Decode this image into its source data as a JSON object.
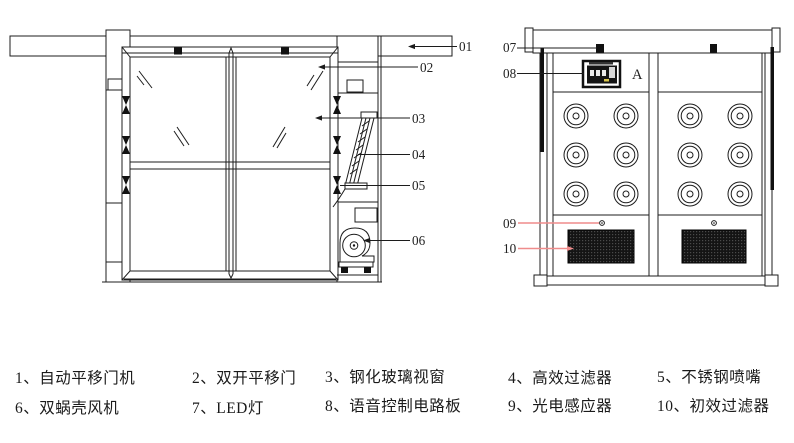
{
  "left_view": {
    "callouts": [
      {
        "label": "01"
      },
      {
        "label": "02"
      },
      {
        "label": "03"
      },
      {
        "label": "04"
      },
      {
        "label": "05"
      },
      {
        "label": "06"
      }
    ]
  },
  "right_view": {
    "callouts": [
      {
        "label": "07"
      },
      {
        "label": "08"
      },
      {
        "label": "09"
      },
      {
        "label": "10"
      }
    ],
    "detail_marker": "A"
  },
  "legend": {
    "items": [
      {
        "label": "1、自动平移门机"
      },
      {
        "label": "2、双开平移门"
      },
      {
        "label": "3、钢化玻璃视窗"
      },
      {
        "label": "4、高效过滤器"
      },
      {
        "label": "5、不锈钢喷嘴"
      },
      {
        "label": "6、双蜗壳风机"
      },
      {
        "label": "7、LED灯"
      },
      {
        "label": "8、语音控制电路板"
      },
      {
        "label": "9、光电感应器"
      },
      {
        "label": "10、初效过滤器"
      }
    ]
  },
  "colors": {
    "ink": "#1c1c1c",
    "leader_accent": "#ef8c8c",
    "background": "#ffffff"
  }
}
